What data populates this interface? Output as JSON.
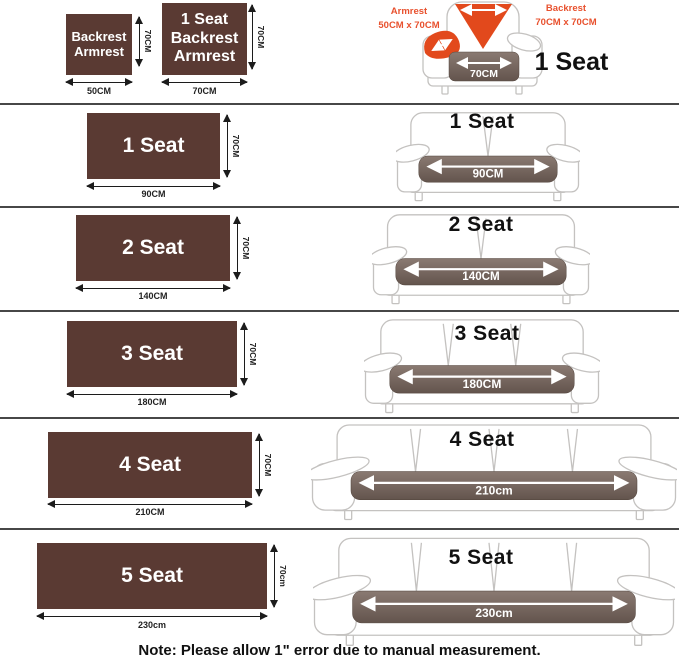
{
  "header": {
    "square_small": {
      "label": "Backrest\nArmrest",
      "width_label": "50CM",
      "height_label": "70CM"
    },
    "square_large": {
      "label": "1 Seat\nBackrest\nArmrest",
      "width_label": "70CM",
      "height_label": "70CM"
    },
    "chair": {
      "armrest_label": "Armrest\n50CM x 70CM",
      "backrest_label": "Backrest\n70CM x 70CM",
      "cushion_label": "70CM",
      "seat_label": "1 Seat"
    }
  },
  "rows": [
    {
      "label": "1 Seat",
      "width_label": "90CM",
      "height_label": "70CM",
      "sofa_title": "1 Seat",
      "cushion_label": "90CM",
      "sections": 2
    },
    {
      "label": "2 Seat",
      "width_label": "140CM",
      "height_label": "70CM",
      "sofa_title": "2 Seat",
      "cushion_label": "140CM",
      "sections": 2
    },
    {
      "label": "3 Seat",
      "width_label": "180CM",
      "height_label": "70CM",
      "sofa_title": "3 Seat",
      "cushion_label": "180CM",
      "sections": 3
    },
    {
      "label": "4 Seat",
      "width_label": "210CM",
      "height_label": "70CM",
      "sofa_title": "4 Seat",
      "cushion_label": "210cm",
      "sections": 4
    },
    {
      "label": "5 Seat",
      "width_label": "230cm",
      "height_label": "70cm",
      "sofa_title": "5 Seat",
      "cushion_label": "230cm",
      "sections": 4
    }
  ],
  "note": "Note: Please allow 1\" error due to manual measurement.",
  "colors": {
    "swatch_brown": "#5a3a33",
    "cushion_top": "#8a7a72",
    "cushion_bottom": "#63544d",
    "accent_orange": "#e2491c",
    "label_red": "#e8512e",
    "sketch_gray": "#c4c2c0",
    "separator": "#474747"
  }
}
